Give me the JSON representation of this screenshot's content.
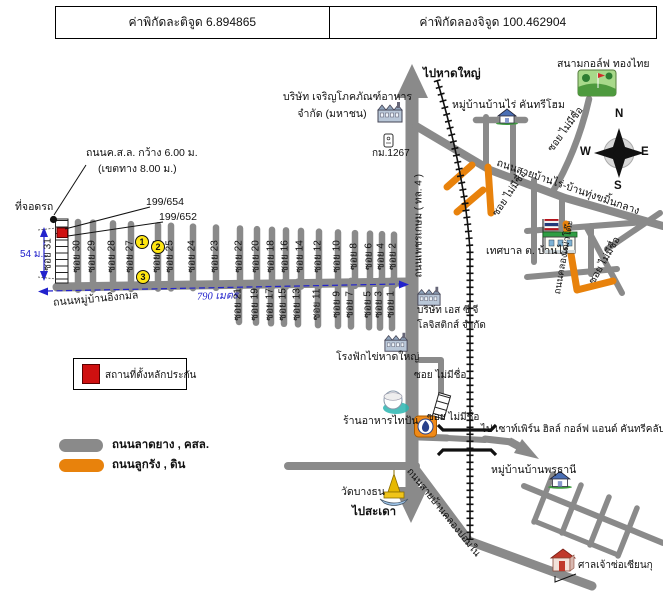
{
  "colors": {
    "road_gray": "#8a8a8a",
    "road_orange": "#e8820c",
    "collateral_red": "#cf1010",
    "measure_blue": "#2222cc",
    "marker_yellow": "#ffe612"
  },
  "header": {
    "latitude": "ค่าพิกัดละติจูด 6.894865",
    "longitude": "ค่าพิกัดลองจิจูด 100.462904"
  },
  "compass": {
    "n": "N",
    "e": "E",
    "w": "W",
    "s": "S"
  },
  "destinations": {
    "hatyai": "ไปหาดใหญ่",
    "sadao": "ไปสะเดา",
    "southern_hills": "ไป เซาท์เพิร์น ฮิลล์ กอล์ฟ แอนด์ คันทรีคลับ"
  },
  "places": {
    "golf_course": "สนามกอล์ฟ ทองไทย",
    "cp_foods_line1": "บริษัท เจริญโภคภัณฑ์อาหาร",
    "cp_foods_line2": "จำกัด (มหาชน)",
    "km_post": "กม.1267",
    "banrai_village": "หมู่บ้านบ้านไร่ คันทรีโฮม",
    "municipality": "เทศบาล ต. บ้านไร่",
    "scg_line1": "บริษัท เอส ซี จี",
    "scg_line2": "โลจิสติกส์ จำกัด",
    "hatchery": "โรงฟักไข่หาดใหญ่",
    "taipan_restaurant": "ร้านอาหารไทปัน",
    "prutani_village": "หมู่บ้านบ้านพรุธานี",
    "wat_bang_thon": "วัดบางธน",
    "shrine": "ศาลเจ้าซ่อเซียนกุ",
    "parking": "ที่จอดรถ",
    "house_no_1": "199/654",
    "house_no_2": "199/652"
  },
  "roads": {
    "phetkasem": "ถนนเพชรเกษม ( ทล. 4 )",
    "banrai_thungkamin": "ถนนสายบ้านไร่-บ้านทุ่งขมิ้นกลาง",
    "klongpom": "ถนนสายบ้านคลองปอมใน",
    "klongtao": "ถนนคลองเฒ่าโต๊ะ",
    "soi_no_name": "ซอย ไม่มีชื่อ",
    "village_road": "ถนนหมู่บ้านอิงกมล",
    "spec_line1": "ถนนค.ส.ล. กว้าง 6.00 ม.",
    "spec_line2": "(เขตทาง 8.00 ม.)"
  },
  "measurements": {
    "width_54": "54 ม.",
    "length_790": "790 เมตร"
  },
  "legend": {
    "collateral": "สถานที่ตั้งหลักประกัน",
    "paved": "ถนนลาดยาง , คสล.",
    "dirt": "ถนนลูกรัง , ดิน"
  },
  "sois": {
    "top": [
      "ซอย 31",
      "ซอย 30",
      "ซอย 29",
      "ซอย 28",
      "ซอย 27",
      "ซอย 26",
      "ซอย 25",
      "ซอย 24",
      "ซอย 23",
      "ซอย 22",
      "ซอย 20",
      "ซอย 18",
      "ซอย 16",
      "ซอย 14",
      "ซอย 12",
      "ซอย 10",
      "ซอย 8",
      "ซอย 6",
      "ซอย 4",
      "ซอย 2"
    ],
    "bottom": [
      "ซอย 21",
      "ซอย 19",
      "ซอย 17",
      "ซอย 15",
      "ซอย 13",
      "ซอย 11",
      "ซอย 9",
      "ซอย 7",
      "ซอย 5",
      "ซอย 3",
      "ซอย 1"
    ]
  },
  "markers": [
    "1",
    "2",
    "3"
  ]
}
